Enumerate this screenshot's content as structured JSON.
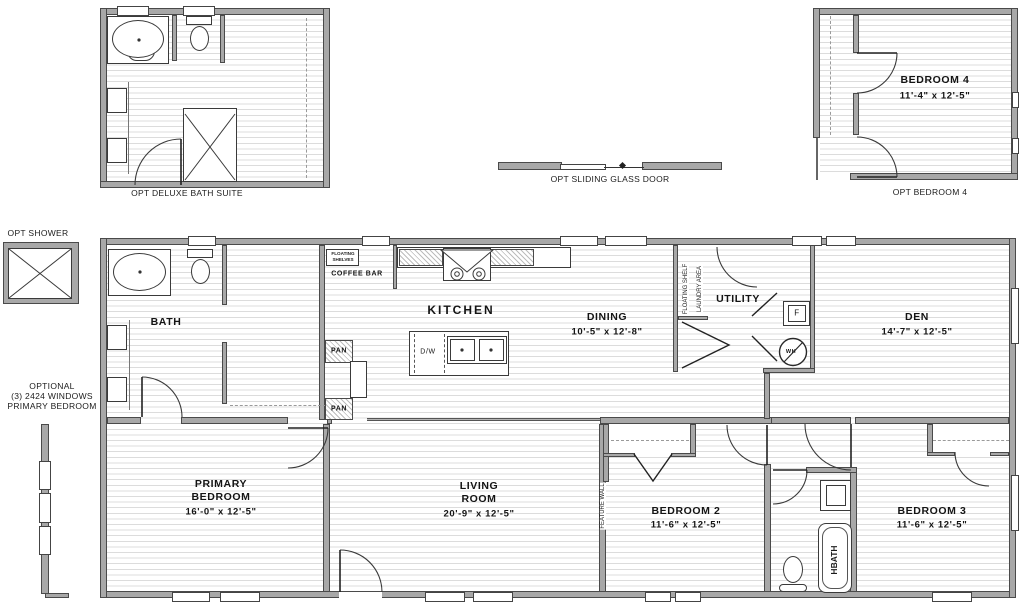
{
  "drawing_title": "floor-plan",
  "colors": {
    "wall_fill": "#a8a8a8",
    "wall_edge": "#4a4a4a",
    "line": "#333333",
    "floor_line": "#dcdcdc",
    "text": "#141414"
  },
  "options": {
    "deluxe_bath": {
      "label": "OPT DELUXE BATH SUITE"
    },
    "sliding_door": {
      "label": "OPT SLIDING GLASS DOOR"
    },
    "bedroom4": {
      "label": "OPT BEDROOM 4",
      "room": "BEDROOM 4",
      "dims": "11'-4\" x  12'-5\""
    },
    "shower": {
      "label": "OPT SHOWER"
    },
    "windows": {
      "line1": "OPTIONAL",
      "line2": "(3) 2424 WINDOWS",
      "line3": "PRIMARY BEDROOM"
    }
  },
  "rooms": {
    "bath": {
      "name": "BATH"
    },
    "kitchen": {
      "name": "KITCHEN"
    },
    "dining": {
      "name": "DINING",
      "dims": "10'-5\" x  12'-8\""
    },
    "utility": {
      "name": "UTILITY"
    },
    "den": {
      "name": "DEN",
      "dims": "14'-7\" x  12'-5\""
    },
    "primary": {
      "line1": "PRIMARY",
      "line2": "BEDROOM",
      "dims": "16'-0\" x  12'-5\""
    },
    "living": {
      "line1": "LIVING",
      "line2": "ROOM",
      "dims": "20'-9\" x  12'-5\""
    },
    "bedroom2": {
      "name": "BEDROOM 2",
      "dims": "11'-6\" x  12'-5\""
    },
    "bedroom3": {
      "name": "BEDROOM 3",
      "dims": "11'-6\" x  12'-5\""
    },
    "hbath": {
      "name": "HBATH"
    }
  },
  "annotations": {
    "floating_shelves_1": "FLOATING",
    "floating_shelves_2": "SHELVES",
    "coffee_bar": "COFFEE BAR",
    "pan_upper": "PAN",
    "pan_lower": "PAN",
    "dishwasher": "D/W",
    "floating_shelf": "FLOATING SHELF",
    "laundry_area": "LAUNDRY AREA",
    "feature_wall": "FEATURE WALL",
    "furnace": "F",
    "water_heater": "WH"
  }
}
